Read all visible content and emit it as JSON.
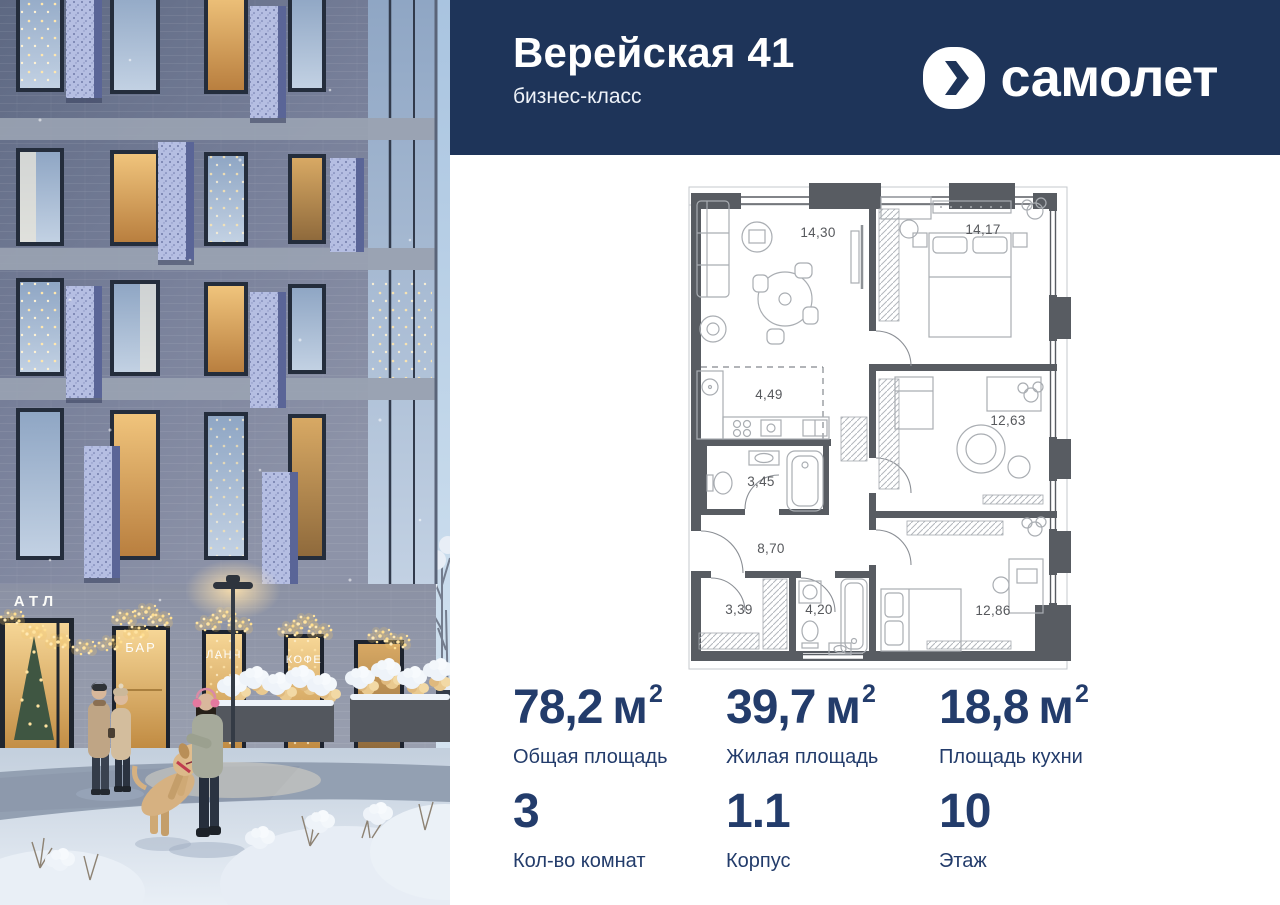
{
  "header": {
    "title": "Верейская 41",
    "subtitle": "бизнес-класс",
    "brand": "самолет"
  },
  "floor_plan": {
    "rooms": [
      "14,30",
      "14,17",
      "4,49",
      "12,63",
      "3,45",
      "8,70",
      "3,39",
      "4,20",
      "12,86"
    ]
  },
  "stats": {
    "areas": [
      {
        "value": "78,2",
        "unit": "м",
        "sup": "2",
        "label": "Общая площадь"
      },
      {
        "value": "39,7",
        "unit": "м",
        "sup": "2",
        "label": "Жилая площадь"
      },
      {
        "value": "18,8",
        "unit": "м",
        "sup": "2",
        "label": "Площадь кухни"
      }
    ],
    "details": [
      {
        "value": "3",
        "label": "Кол-во комнат"
      },
      {
        "value": "1.1",
        "label": "Корпус"
      },
      {
        "value": "10",
        "label": "Этаж"
      }
    ]
  },
  "photo": {
    "signs": {
      "entrance": "АТЛ",
      "bar": "БАР",
      "lunch": "ЛАНЧ",
      "coffee": "КОФЕ"
    }
  },
  "colors": {
    "brand_navy": "#1e3459",
    "stats_text": "#233c6b",
    "plan_wall": "#585c62",
    "garland_gold": "#ffd98c"
  }
}
